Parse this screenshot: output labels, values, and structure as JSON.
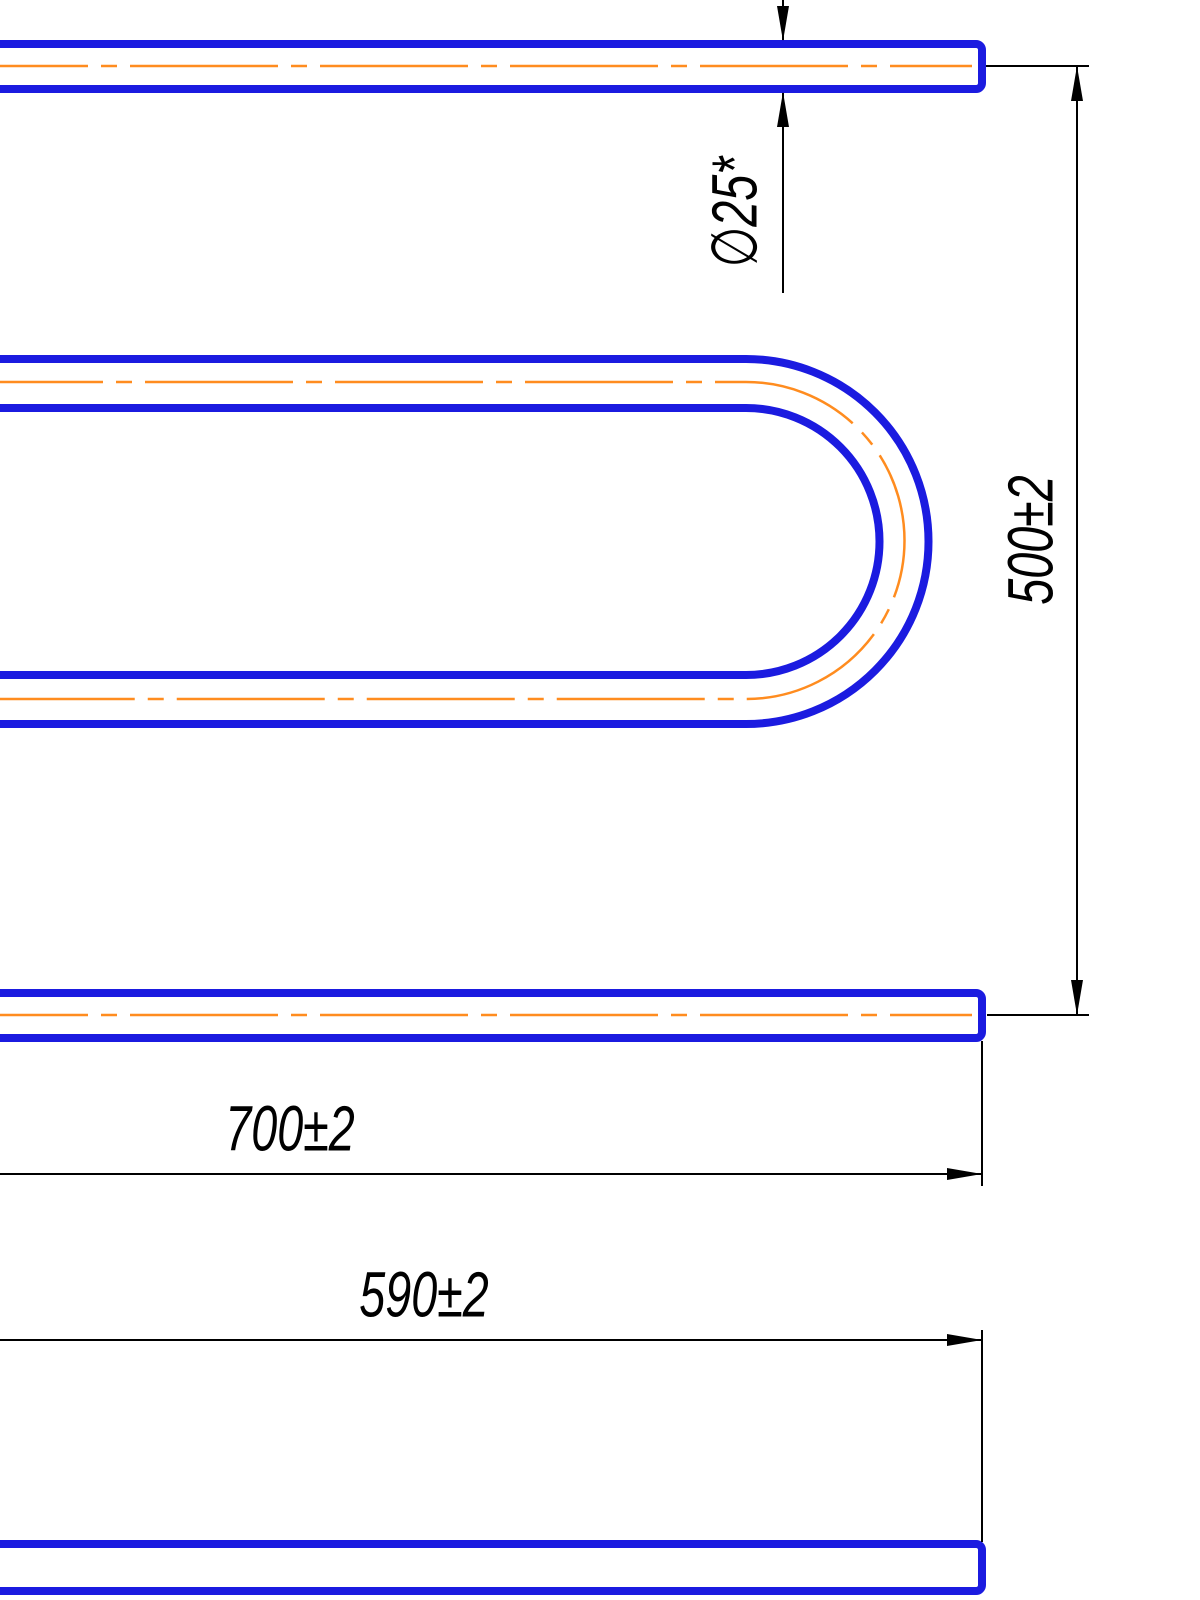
{
  "drawing": {
    "kind": "technical-drawing",
    "subject": "u-shaped-pipe-with-dimensions",
    "colors": {
      "background": "#ffffff",
      "pipe_outline": "#1b1be0",
      "centerline": "#ff8c1f",
      "dimension": "#000000"
    },
    "labels": {
      "diameter": "∅25*",
      "height": "500±2",
      "length_top": "700±2",
      "length_bottom": "590±2"
    },
    "values": {
      "diameter_mm": 25,
      "diameter_note": "*",
      "height_mm": 500,
      "height_tolerance": "±2",
      "length_top_mm": 700,
      "length_top_tolerance": "±2",
      "length_bottom_mm": 590,
      "length_bottom_tolerance": "±2"
    }
  }
}
